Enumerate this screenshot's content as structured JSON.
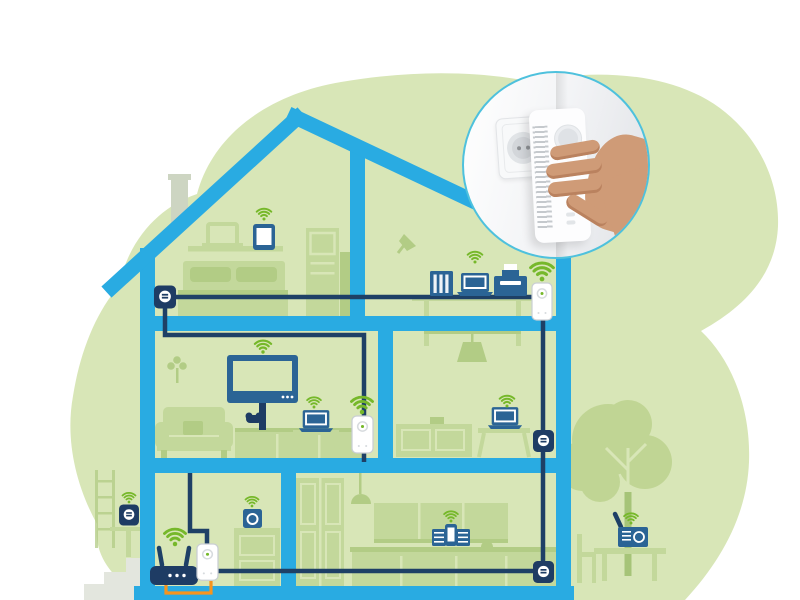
{
  "title": "Whole-home powerline WiFi network illustration",
  "description": "Cross-section of a house on a green organic background. A powerline network (dark blue cable) links wall-socket adapters and WiFi powerline adapters in every room; green WiFi signal icons mark connected devices. A circular inset photo shows a hand plugging a white powerline adapter into a wall socket.",
  "colors": {
    "background": "#ffffff",
    "blob": "#d8e6b7",
    "silhouette": "#c3d89b",
    "silhouette_dark": "#b2cc85",
    "gray_green": "#cdd5c2",
    "steps_gray": "#e3e6de",
    "house_blue": "#29abe2",
    "cable_navy": "#1e4066",
    "device_blue": "#2b6495",
    "device_navy": "#1e3c64",
    "wifi_green": "#76b82a",
    "cable_orange": "#f7941d",
    "adapter_border": "#c9ced3",
    "adapter_detail": "#d7dbde",
    "inset_ring": "#4ec1dd",
    "skin": "#cf9b77",
    "skin_shadow": "#ba825f",
    "tree": "#c0d594",
    "tree_dark": "#a6c478"
  },
  "icons": {
    "wifi-icon": "three concentric green signal arcs over a dot",
    "socket-adapter-icon": "dark navy rounded square with white socket circle",
    "powerline-adapter-icon": "white rounded vertical adapter with round outlet and green dot"
  },
  "rooms": [
    {
      "name": "attic-bedroom",
      "items": [
        "wall-socket-adapter",
        "shelf-with-laptop",
        "tablet-with-wifi",
        "bed",
        "wardrobe",
        "chimney-outside"
      ]
    },
    {
      "name": "attic-office",
      "items": [
        "desk-lamp",
        "shelf-desk",
        "nas-server",
        "laptop-with-wifi",
        "printer",
        "powerline-wifi-adapter-with-wifi"
      ]
    },
    {
      "name": "living-room",
      "items": [
        "hanging-plant",
        "sofa",
        "wall-tv-with-wifi",
        "game-controller",
        "sideboard",
        "side-table",
        "laptop-with-wifi",
        "powerline-wifi-adapter-with-wifi"
      ]
    },
    {
      "name": "study-room",
      "items": [
        "pendant-lamp",
        "sideboard",
        "desk",
        "laptop-with-wifi",
        "wall-socket-adapter"
      ]
    },
    {
      "name": "hallway-room",
      "items": [
        "wifi-router-with-wifi",
        "powerline-wifi-adapter",
        "ethernet-cable-orange",
        "dresser",
        "speaker-with-wifi"
      ]
    },
    {
      "name": "kitchen",
      "items": [
        "tall-cupboards",
        "pendant-lamp",
        "wall-cabinets",
        "music-dock-with-wifi",
        "kitchen-counter",
        "wall-socket-adapter"
      ]
    },
    {
      "name": "garden-left",
      "items": [
        "ladder",
        "garden-shelf",
        "outdoor-speaker-with-wifi",
        "stone-steps"
      ]
    },
    {
      "name": "garden-right",
      "items": [
        "tree",
        "garden-chair",
        "garden-table",
        "radio-with-wifi"
      ]
    }
  ],
  "network": {
    "backbone": "powerline cable through walls and floors",
    "adapter_count": 6,
    "wifi_hotspot_count": 12
  },
  "inset": {
    "shape": "circle",
    "content": "photo of a hand plugging a white powerline adapter into the wall next to an existing power socket"
  }
}
